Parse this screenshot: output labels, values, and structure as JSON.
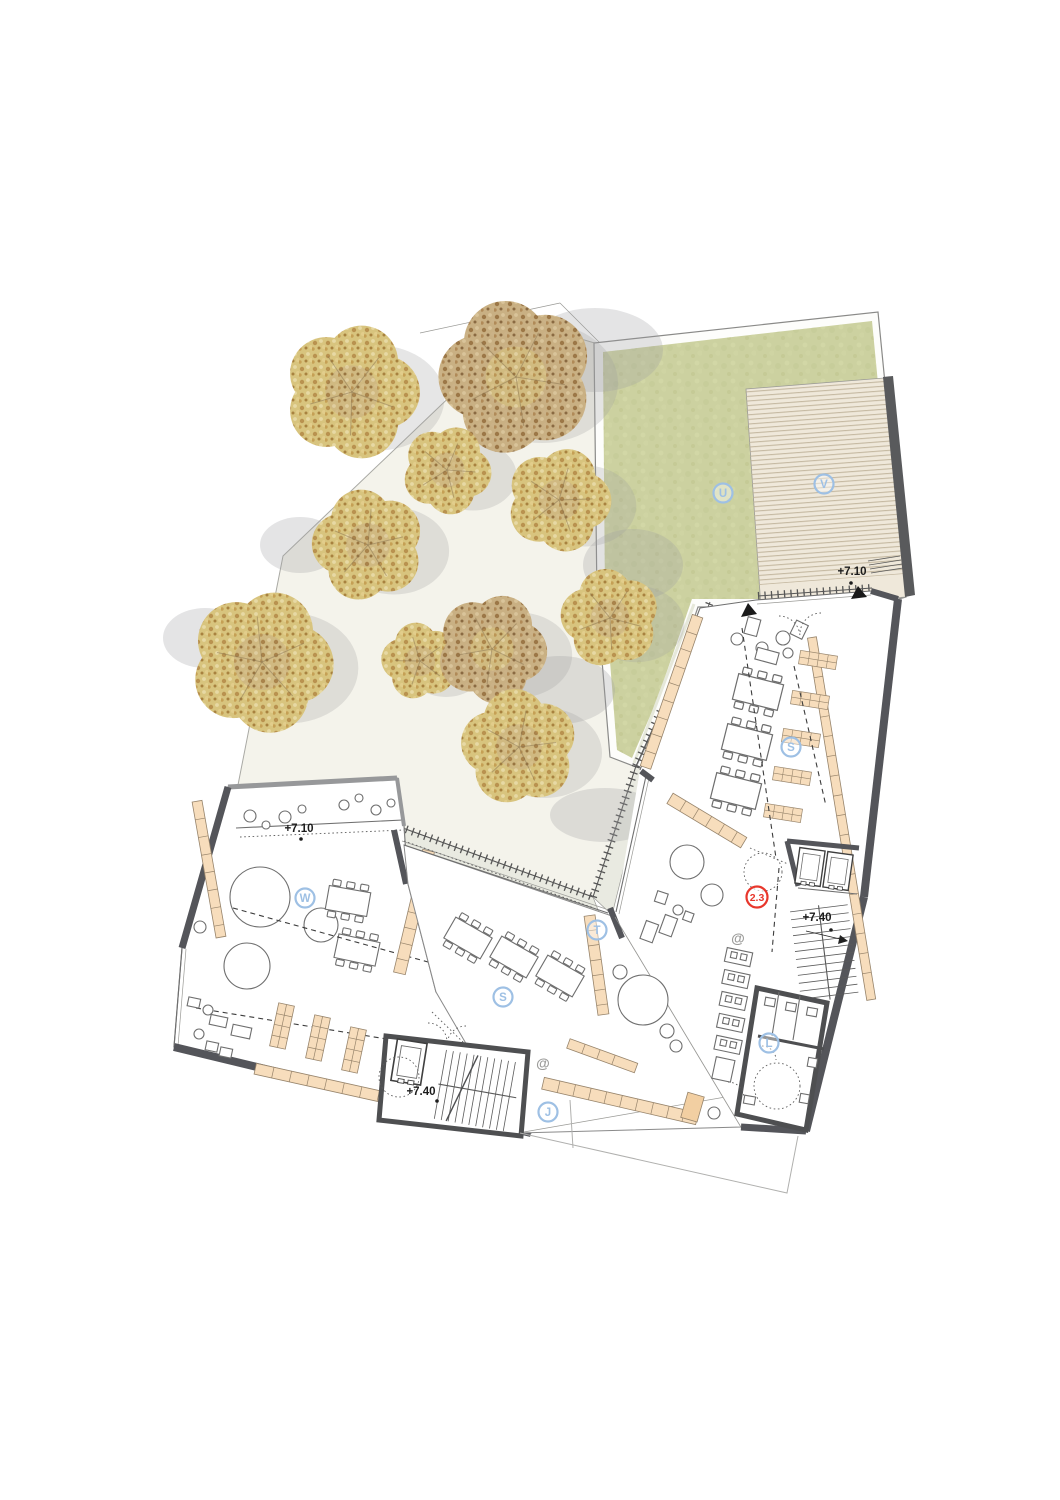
{
  "document": {
    "type": "architectural floor plan",
    "description": "upper floor plan with roof lawn, wooden deck, tree courtyard and classroom wings"
  },
  "colors": {
    "wall_dark": "#54555a",
    "wall_mid": "#97989a",
    "courtyard": "#f4f3eb",
    "walkway": "#e9eae1",
    "lawn": "#ccd1a0",
    "lawn_margin": "#fdfdfb",
    "deck_base": "#efe8da",
    "deck_stripe": "#bdb098",
    "furniture_fill": "#f7ddbc",
    "furniture_stroke": "#97846b",
    "label_blue": "#9ec0e4",
    "label_red": "#e8372c",
    "text_dark": "#1c1c1c",
    "at_gray": "#9b9b99",
    "tree_gold": "#d8c47e",
    "tree_brown": "#c9b083",
    "shadow_gray": "#9e9fa0"
  },
  "zone_labels": [
    {
      "text": "U",
      "name": "zone-label-lawn-u",
      "x": 723,
      "y": 493
    },
    {
      "text": "V",
      "name": "zone-label-deck-v",
      "x": 824,
      "y": 484
    },
    {
      "text": "S",
      "name": "zone-label-room-s-upper",
      "x": 791,
      "y": 747
    },
    {
      "text": "W",
      "name": "zone-label-room-w",
      "x": 305,
      "y": 898
    },
    {
      "text": "T",
      "name": "zone-label-terrace-t",
      "x": 597,
      "y": 930
    },
    {
      "text": "S",
      "name": "zone-label-room-s-middle",
      "x": 503,
      "y": 997
    },
    {
      "text": "L",
      "name": "zone-label-toilets-l",
      "x": 769,
      "y": 1043
    },
    {
      "text": "J",
      "name": "zone-label-corridor-j",
      "x": 548,
      "y": 1112
    }
  ],
  "room_number": {
    "text": "2.3",
    "x": 757,
    "y": 897
  },
  "level_marks": [
    {
      "text": "+7.10",
      "name": "level-mark-deck",
      "x": 852,
      "y": 575,
      "dx": -1,
      "dy": 8
    },
    {
      "text": "+7.10",
      "name": "level-mark-terrace",
      "x": 299,
      "y": 832,
      "dx": 2,
      "dy": 7
    },
    {
      "text": "+7.40",
      "name": "level-mark-core-stair",
      "x": 817,
      "y": 921,
      "dx": 14,
      "dy": 9
    },
    {
      "text": "+7.40",
      "name": "level-mark-west-stair",
      "x": 421,
      "y": 1095,
      "dx": 16,
      "dy": 6
    }
  ],
  "at_marks": [
    {
      "text": "@",
      "name": "media-mark-hall",
      "x": 738,
      "y": 943
    },
    {
      "text": "@",
      "name": "media-mark-corridor",
      "x": 543,
      "y": 1068
    }
  ],
  "trees": [
    {
      "x": 352,
      "y": 392,
      "r": 70,
      "v": "A"
    },
    {
      "x": 516,
      "y": 377,
      "r": 80,
      "v": "B"
    },
    {
      "x": 559,
      "y": 500,
      "r": 54,
      "v": "A"
    },
    {
      "x": 368,
      "y": 545,
      "r": 58,
      "v": "A"
    },
    {
      "x": 262,
      "y": 662,
      "r": 74,
      "v": "A"
    },
    {
      "x": 420,
      "y": 661,
      "r": 40,
      "v": "A"
    },
    {
      "x": 492,
      "y": 649,
      "r": 57,
      "v": "B"
    },
    {
      "x": 610,
      "y": 618,
      "r": 51,
      "v": "A"
    },
    {
      "x": 447,
      "y": 470,
      "r": 46,
      "v": "A"
    },
    {
      "x": 519,
      "y": 747,
      "r": 60,
      "v": "A"
    }
  ],
  "shadow_blobs": [
    {
      "x": 595,
      "y": 350,
      "rx": 68,
      "ry": 42
    },
    {
      "x": 633,
      "y": 565,
      "rx": 50,
      "ry": 36
    },
    {
      "x": 300,
      "y": 545,
      "rx": 40,
      "ry": 28
    },
    {
      "x": 560,
      "y": 690,
      "rx": 55,
      "ry": 34
    },
    {
      "x": 605,
      "y": 815,
      "rx": 55,
      "ry": 27
    },
    {
      "x": 205,
      "y": 638,
      "rx": 42,
      "ry": 30
    }
  ]
}
